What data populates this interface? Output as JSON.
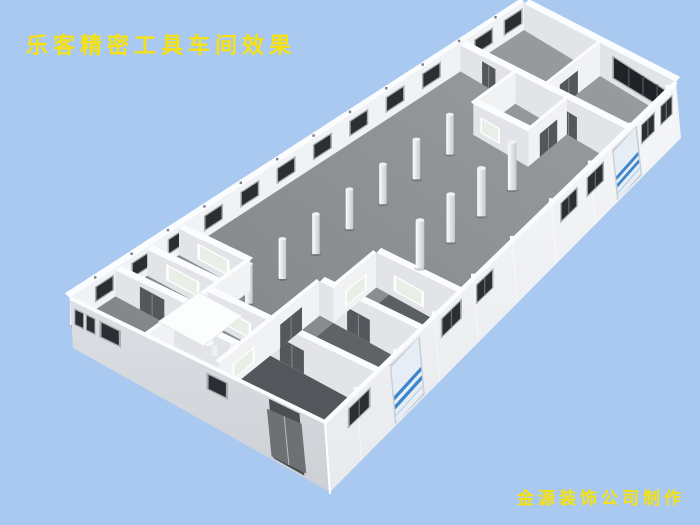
{
  "scene": {
    "title": "乐客精密工具车间效果",
    "credit": "金源装饰公司制作"
  },
  "colors": {
    "background": "#a9c9f1",
    "text_yellow": "#f6e112",
    "floor_light": "#9b9ea1",
    "floor_dark": "#7e8184",
    "wall_bright": "#f5f6f8",
    "wall_lit": "#f1f2f4",
    "wall_mid": "#e2e4e8",
    "wall_shadow": "#dcdfe3",
    "white_edge": "#fbfcfd",
    "window_dark": "#2b2e32",
    "window_frame": "#aaaeb2",
    "window_band": "#1f2226",
    "interior_window": "#e9eee7",
    "door_dark": "#54575b",
    "door_gray": "#6e7174",
    "recess_dark": "#4b4e52",
    "blue_door_panel": "#e6edf4",
    "blue_stripe": "#3e86cc",
    "column_light": "#fdfdfe",
    "column_dark": "#c6c9cd"
  }
}
